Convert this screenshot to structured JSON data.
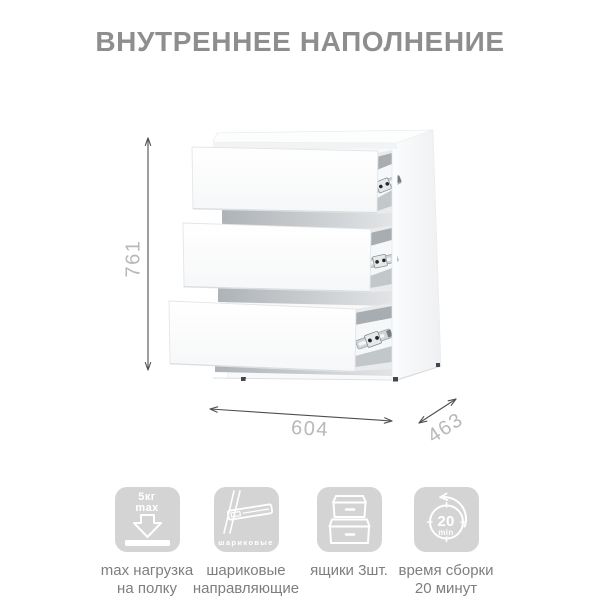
{
  "title": "ВНУТРЕННЕЕ НАПОЛНЕНИЕ",
  "dimensions": {
    "height": "761",
    "width": "604",
    "depth": "463"
  },
  "features": [
    {
      "icon": "max-load-shelf-icon",
      "badge": {
        "line1": "5кг",
        "line2": "max"
      },
      "label": "max нагрузка\nна полку"
    },
    {
      "icon": "ball-bearing-slides-icon",
      "badge": {
        "caption": "шариковые"
      },
      "label": "шариковые\nнаправляющие"
    },
    {
      "icon": "drawers-icon",
      "badge": {},
      "label": "ящики 3шт."
    },
    {
      "icon": "assembly-time-icon",
      "badge": {
        "value": "20",
        "unit": "min"
      },
      "label": "время сборки\n20 минут"
    }
  ],
  "colors": {
    "badge": "#d4d4d4",
    "label_text": "#7e7e7e",
    "title_text": "#8e8e8e",
    "dimension_label": "#b6b8bb",
    "dimension_line": "#4f4f4f"
  }
}
